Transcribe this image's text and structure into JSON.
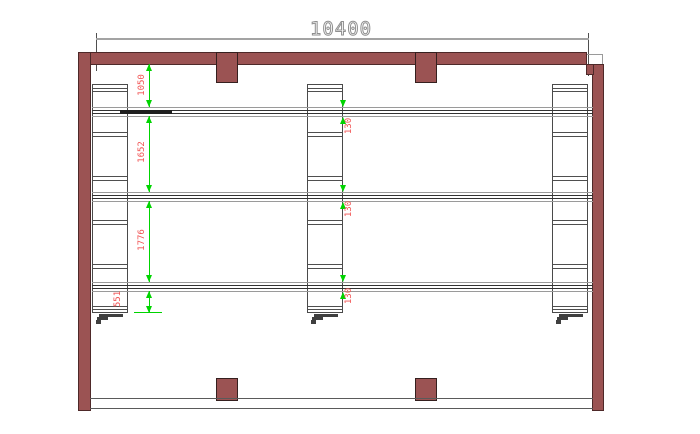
{
  "dimensions": {
    "overall_width": "10400",
    "bay_spacings": [
      "1050",
      "1652",
      "1776",
      "551"
    ],
    "rail_widths": [
      "130",
      "130",
      "130"
    ]
  },
  "colors": {
    "wall_fill": "#9b5353",
    "wall_outline": "#4e2929",
    "dimension_text_red": "#f15353",
    "dimension_line_green": "#00d400",
    "dimension_line_gray": "#a3a3a3",
    "drawing_line": "#4f4f4f",
    "background": "#ffffff"
  }
}
